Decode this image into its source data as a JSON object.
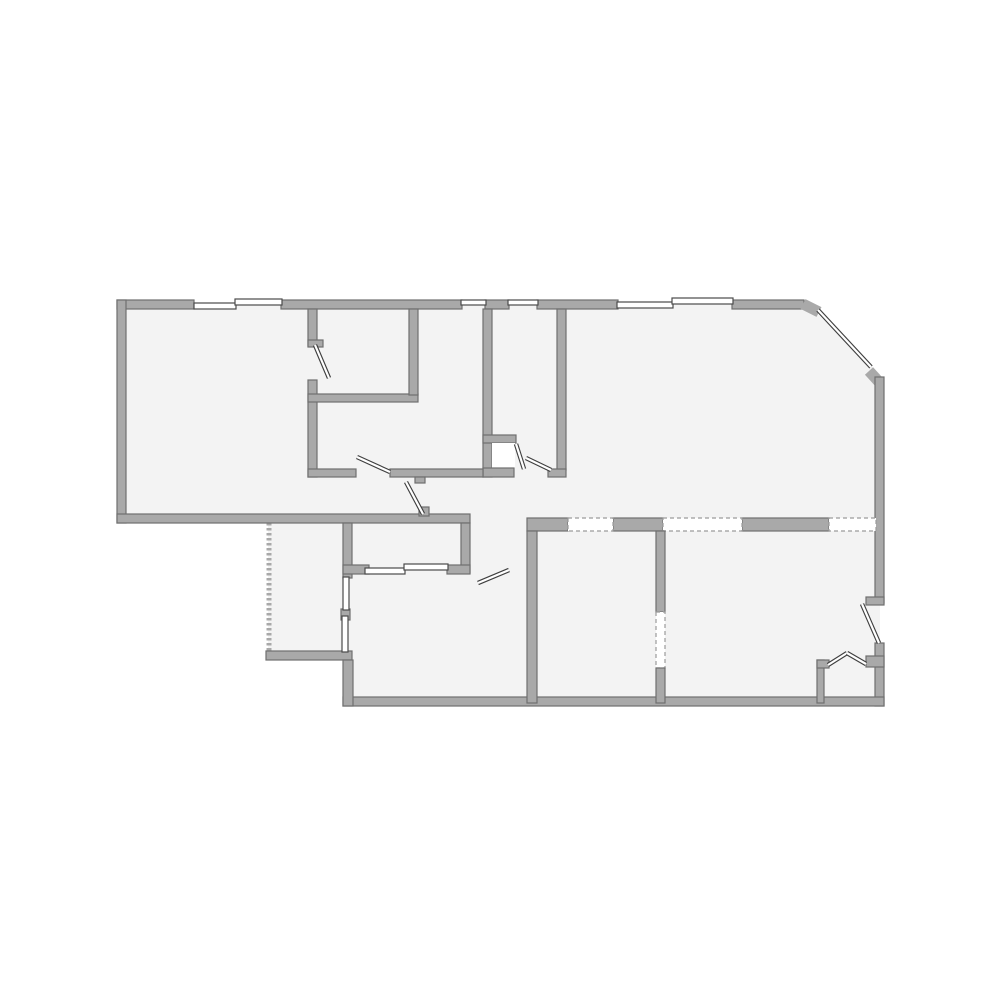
{
  "page": {
    "kind": "architectural floor plan drawing",
    "background": "#ffffff",
    "width": 1000,
    "height": 1000
  },
  "floorplan": {
    "colors": {
      "wall": "#a9a9a9",
      "wall_edge": "#6f6f6f",
      "floor": "#f3f3f3",
      "white": "#ffffff",
      "window_stroke": "#4a4a4a",
      "door_line": "#3f3f3f",
      "dash": "#9b9b9b",
      "background": "#ffffff"
    },
    "shapes": [
      {
        "t": "poly",
        "n": "building-footprint",
        "f": "floor",
        "pts": "121,304 807,304 880,374 880,702 348,702 348,657 268,657 268,519 121,519"
      },
      {
        "t": "line",
        "n": "porch-dashed-wall",
        "x1": 269,
        "y1": 523,
        "x2": 269,
        "y2": 653,
        "sc": "wall",
        "w": 5,
        "dash": "2.5,2.5"
      },
      {
        "t": "rect",
        "n": "top-wall-seg-1",
        "x": 117,
        "y": 300,
        "w": 77,
        "h": 9,
        "f": "wall",
        "s": "wall_edge"
      },
      {
        "t": "rect",
        "n": "top-wall-seg-2",
        "x": 281,
        "y": 300,
        "w": 181,
        "h": 9,
        "f": "wall",
        "s": "wall_edge"
      },
      {
        "t": "rect",
        "n": "top-wall-seg-3",
        "x": 485,
        "y": 300,
        "w": 24,
        "h": 9,
        "f": "wall",
        "s": "wall_edge"
      },
      {
        "t": "rect",
        "n": "top-wall-seg-4",
        "x": 537,
        "y": 300,
        "w": 81,
        "h": 9,
        "f": "wall",
        "s": "wall_edge"
      },
      {
        "t": "rect",
        "n": "top-wall-seg-5",
        "x": 732,
        "y": 300,
        "w": 72,
        "h": 9,
        "f": "wall",
        "s": "wall_edge"
      },
      {
        "t": "line",
        "n": "chamfer-wall-stub-top",
        "x1": 803,
        "y1": 304,
        "x2": 819,
        "y2": 312,
        "sc": "wall",
        "w": 11
      },
      {
        "t": "line",
        "n": "chamfer-wall-stub-bottom",
        "x1": 869,
        "y1": 371,
        "x2": 879,
        "y2": 382,
        "sc": "wall",
        "w": 11
      },
      {
        "t": "rect",
        "n": "left-exterior-wall",
        "x": 117,
        "y": 300,
        "w": 9,
        "h": 223,
        "f": "wall",
        "s": "wall_edge"
      },
      {
        "t": "rect",
        "n": "left-room-bottom-wall",
        "x": 117,
        "y": 514,
        "w": 353,
        "h": 9,
        "f": "wall",
        "s": "wall_edge"
      },
      {
        "t": "rect",
        "n": "right-exterior-wall-upper",
        "x": 875,
        "y": 377,
        "w": 9,
        "h": 226,
        "f": "wall",
        "s": "wall_edge"
      },
      {
        "t": "rect",
        "n": "right-exterior-wall-lower",
        "x": 875,
        "y": 643,
        "w": 9,
        "h": 63,
        "f": "wall",
        "s": "wall_edge"
      },
      {
        "t": "rect",
        "n": "bottom-exterior-wall",
        "x": 343,
        "y": 697,
        "w": 541,
        "h": 9,
        "f": "wall",
        "s": "wall_edge"
      },
      {
        "t": "rect",
        "n": "room1-right-wall-upper",
        "x": 308,
        "y": 309,
        "w": 9,
        "h": 37,
        "f": "wall",
        "s": "wall_edge"
      },
      {
        "t": "rect",
        "n": "room1-door-flag",
        "x": 308,
        "y": 340,
        "w": 15,
        "h": 7,
        "f": "wall",
        "s": "wall_edge"
      },
      {
        "t": "rect",
        "n": "room1-right-wall-lower",
        "x": 308,
        "y": 380,
        "w": 9,
        "h": 97,
        "f": "wall",
        "s": "wall_edge"
      },
      {
        "t": "rect",
        "n": "room2-bottom-wall",
        "x": 308,
        "y": 394,
        "w": 110,
        "h": 8,
        "f": "wall",
        "s": "wall_edge"
      },
      {
        "t": "rect",
        "n": "room2-right-wall",
        "x": 409,
        "y": 309,
        "w": 9,
        "h": 86,
        "f": "wall",
        "s": "wall_edge"
      },
      {
        "t": "rect",
        "n": "hall-room-left-wall",
        "x": 483,
        "y": 309,
        "w": 9,
        "h": 168,
        "f": "wall",
        "s": "wall_edge"
      },
      {
        "t": "rect",
        "n": "entry-closet-top-wall",
        "x": 483,
        "y": 435,
        "w": 33,
        "h": 8,
        "f": "wall",
        "s": "wall_edge"
      },
      {
        "t": "rect",
        "n": "entry-closet-floor",
        "x": 492,
        "y": 443,
        "w": 23,
        "h": 25,
        "f": "white"
      },
      {
        "t": "rect",
        "n": "entry-closet-bottom-wall",
        "x": 483,
        "y": 468,
        "w": 31,
        "h": 9,
        "f": "wall",
        "s": "wall_edge"
      },
      {
        "t": "rect",
        "n": "middle-room-bottom-wall-left",
        "x": 308,
        "y": 469,
        "w": 48,
        "h": 8,
        "f": "wall",
        "s": "wall_edge"
      },
      {
        "t": "rect",
        "n": "middle-room-bottom-wall-right",
        "x": 390,
        "y": 469,
        "w": 93,
        "h": 8,
        "f": "wall",
        "s": "wall_edge"
      },
      {
        "t": "rect",
        "n": "hall-door-stub-top",
        "x": 415,
        "y": 477,
        "w": 10,
        "h": 6,
        "f": "wall",
        "s": "wall_edge"
      },
      {
        "t": "rect",
        "n": "hall-door-stub-bottom",
        "x": 419,
        "y": 507,
        "w": 10,
        "h": 9,
        "f": "wall",
        "s": "wall_edge"
      },
      {
        "t": "rect",
        "n": "hall-room-right-wall",
        "x": 557,
        "y": 309,
        "w": 9,
        "h": 161,
        "f": "wall",
        "s": "wall_edge"
      },
      {
        "t": "rect",
        "n": "hall-room-door-hinge-stub",
        "x": 548,
        "y": 469,
        "w": 18,
        "h": 8,
        "f": "wall",
        "s": "wall_edge"
      },
      {
        "t": "rect",
        "n": "closet-row-left-wall",
        "x": 343,
        "y": 523,
        "w": 9,
        "h": 55,
        "f": "wall",
        "s": "wall_edge"
      },
      {
        "t": "rect",
        "n": "closet-row-left-stub",
        "x": 343,
        "y": 565,
        "w": 26,
        "h": 9,
        "f": "wall",
        "s": "wall_edge"
      },
      {
        "t": "rect",
        "n": "closet-row-right-wall",
        "x": 461,
        "y": 523,
        "w": 9,
        "h": 50,
        "f": "wall",
        "s": "wall_edge"
      },
      {
        "t": "rect",
        "n": "closet-row-bottom-stub",
        "x": 447,
        "y": 565,
        "w": 23,
        "h": 9,
        "f": "wall",
        "s": "wall_edge"
      },
      {
        "t": "rect",
        "n": "porch-bottom-wall",
        "x": 266,
        "y": 651,
        "w": 86,
        "h": 9,
        "f": "wall",
        "s": "wall_edge"
      },
      {
        "t": "rect",
        "n": "porch-window-mid-stub",
        "x": 341,
        "y": 609,
        "w": 9,
        "h": 11,
        "f": "wall",
        "s": "wall_edge"
      },
      {
        "t": "rect",
        "n": "bottom-mid-room-left-wall",
        "x": 343,
        "y": 660,
        "w": 10,
        "h": 46,
        "f": "wall",
        "s": "wall_edge"
      },
      {
        "t": "rect",
        "n": "lower-top-wall-seg-1",
        "x": 527,
        "y": 518,
        "w": 41,
        "h": 13,
        "f": "wall",
        "s": "wall_edge"
      },
      {
        "t": "rect",
        "n": "lower-top-wall-seg-2",
        "x": 613,
        "y": 518,
        "w": 50,
        "h": 13,
        "f": "wall",
        "s": "wall_edge"
      },
      {
        "t": "rect",
        "n": "lower-top-wall-seg-3",
        "x": 742,
        "y": 518,
        "w": 87,
        "h": 13,
        "f": "wall",
        "s": "wall_edge"
      },
      {
        "t": "rect",
        "n": "lower-top-opening-1",
        "x": 568,
        "y": 518,
        "w": 45,
        "h": 13,
        "f": "white",
        "s": "dash",
        "dash": "4,3"
      },
      {
        "t": "rect",
        "n": "lower-top-opening-2",
        "x": 663,
        "y": 518,
        "w": 79,
        "h": 13,
        "f": "white",
        "s": "dash",
        "dash": "4,3"
      },
      {
        "t": "rect",
        "n": "lower-top-opening-3",
        "x": 829,
        "y": 518,
        "w": 47,
        "h": 13,
        "f": "white",
        "s": "dash",
        "dash": "4,3"
      },
      {
        "t": "rect",
        "n": "bottom-mid-right-wall",
        "x": 527,
        "y": 531,
        "w": 10,
        "h": 172,
        "f": "wall",
        "s": "wall_edge"
      },
      {
        "t": "rect",
        "n": "bottom-right-divider-upper",
        "x": 656,
        "y": 531,
        "w": 9,
        "h": 81,
        "f": "wall",
        "s": "wall_edge"
      },
      {
        "t": "rect",
        "n": "bottom-right-divider-opening",
        "x": 656,
        "y": 612,
        "w": 9,
        "h": 56,
        "f": "white",
        "s": "dash",
        "dash": "4,3"
      },
      {
        "t": "rect",
        "n": "bottom-right-divider-lower",
        "x": 656,
        "y": 668,
        "w": 9,
        "h": 35,
        "f": "wall",
        "s": "wall_edge"
      },
      {
        "t": "rect",
        "n": "right-door-head-stub",
        "x": 866,
        "y": 597,
        "w": 18,
        "h": 8,
        "f": "wall",
        "s": "wall_edge"
      },
      {
        "t": "rect",
        "n": "corner-closet-left-wall",
        "x": 817,
        "y": 660,
        "w": 7,
        "h": 43,
        "f": "wall",
        "s": "wall_edge"
      },
      {
        "t": "rect",
        "n": "corner-closet-stub-left",
        "x": 817,
        "y": 660,
        "w": 12,
        "h": 8,
        "f": "wall",
        "s": "wall_edge"
      },
      {
        "t": "rect",
        "n": "corner-closet-stub-right",
        "x": 866,
        "y": 656,
        "w": 18,
        "h": 11,
        "f": "wall",
        "s": "wall_edge"
      },
      {
        "t": "rect",
        "n": "window-top-1",
        "x": 194,
        "y": 303,
        "w": 42,
        "h": 6,
        "f": "white",
        "s": "window_stroke"
      },
      {
        "t": "rect",
        "n": "window-top-2",
        "x": 235,
        "y": 299,
        "w": 47,
        "h": 6,
        "f": "white",
        "s": "window_stroke"
      },
      {
        "t": "rect",
        "n": "window-top-3",
        "x": 461,
        "y": 300,
        "w": 25,
        "h": 5,
        "f": "white",
        "s": "window_stroke"
      },
      {
        "t": "rect",
        "n": "window-top-4",
        "x": 508,
        "y": 300,
        "w": 30,
        "h": 5,
        "f": "white",
        "s": "window_stroke"
      },
      {
        "t": "rect",
        "n": "window-top-5",
        "x": 617,
        "y": 302,
        "w": 56,
        "h": 6,
        "f": "white",
        "s": "window_stroke"
      },
      {
        "t": "rect",
        "n": "window-top-6",
        "x": 672,
        "y": 298,
        "w": 61,
        "h": 6,
        "f": "white",
        "s": "window_stroke"
      },
      {
        "t": "dline",
        "n": "window-chamfer",
        "x1": 818,
        "y1": 310,
        "x2": 871,
        "y2": 367
      },
      {
        "t": "rect",
        "n": "window-closet-row-1",
        "x": 365,
        "y": 568,
        "w": 40,
        "h": 6,
        "f": "white",
        "s": "window_stroke"
      },
      {
        "t": "rect",
        "n": "window-closet-row-2",
        "x": 404,
        "y": 564,
        "w": 44,
        "h": 6,
        "f": "white",
        "s": "window_stroke"
      },
      {
        "t": "rect",
        "n": "window-porch-1",
        "x": 343,
        "y": 577,
        "w": 6,
        "h": 33,
        "f": "white",
        "s": "window_stroke"
      },
      {
        "t": "rect",
        "n": "window-porch-2",
        "x": 342,
        "y": 616,
        "w": 6,
        "h": 36,
        "f": "white",
        "s": "window_stroke"
      },
      {
        "t": "dline",
        "n": "door-leaf-room1",
        "x1": 315,
        "y1": 345,
        "x2": 329,
        "y2": 378
      },
      {
        "t": "dline",
        "n": "door-leaf-middle-room",
        "x1": 357,
        "y1": 457,
        "x2": 390,
        "y2": 472
      },
      {
        "t": "dline",
        "n": "door-leaf-hallway",
        "x1": 406,
        "y1": 482,
        "x2": 423,
        "y2": 514
      },
      {
        "t": "dline",
        "n": "door-leaf-entry-closet",
        "x1": 516,
        "y1": 444,
        "x2": 524,
        "y2": 469
      },
      {
        "t": "dline",
        "n": "door-leaf-hall-room",
        "x1": 526,
        "y1": 458,
        "x2": 551,
        "y2": 470
      },
      {
        "t": "dline",
        "n": "door-leaf-bottom-mid-room",
        "x1": 478,
        "y1": 583,
        "x2": 509,
        "y2": 570
      },
      {
        "t": "dline",
        "n": "door-leaf-right-exit",
        "x1": 862,
        "y1": 604,
        "x2": 879,
        "y2": 643
      },
      {
        "t": "dline",
        "n": "door-leaf-bifold-left",
        "x1": 828,
        "y1": 665,
        "x2": 847,
        "y2": 653
      },
      {
        "t": "dline",
        "n": "door-leaf-bifold-right",
        "x1": 847,
        "y1": 653,
        "x2": 866,
        "y2": 664
      }
    ]
  }
}
